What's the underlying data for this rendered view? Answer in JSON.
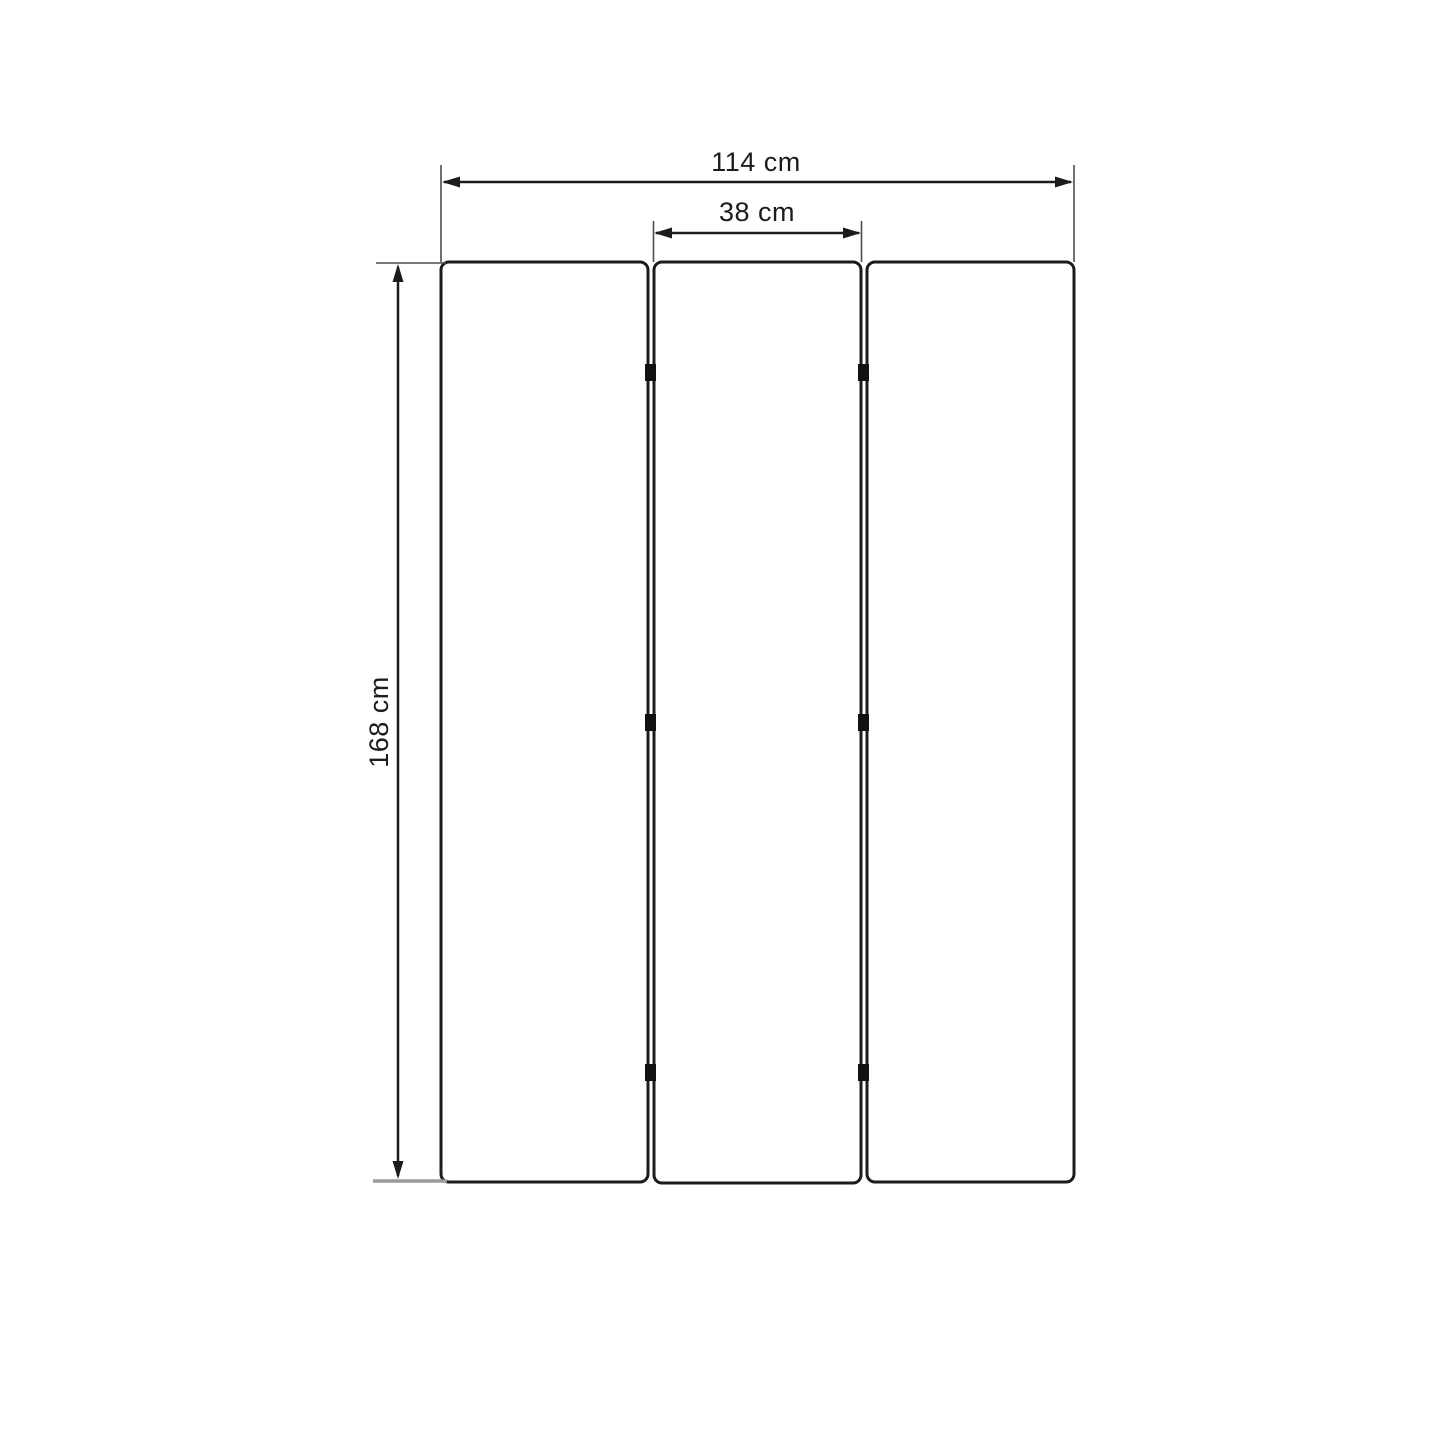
{
  "diagram": {
    "panel_count": 3,
    "unit": "cm",
    "labels": {
      "total_width": "114 cm",
      "panel_width": "38 cm",
      "height": "168 cm"
    },
    "values": {
      "total_width_cm": 114,
      "panel_width_cm": 38,
      "height_cm": 168
    },
    "colors": {
      "background": "#ffffff",
      "panel_line": "#1c1c1c",
      "dimension_line": "#1c1c1c",
      "extension_line": "#4d4d4d",
      "bottom_baseline": "#9a9a9a",
      "hinge": "#111111"
    }
  }
}
